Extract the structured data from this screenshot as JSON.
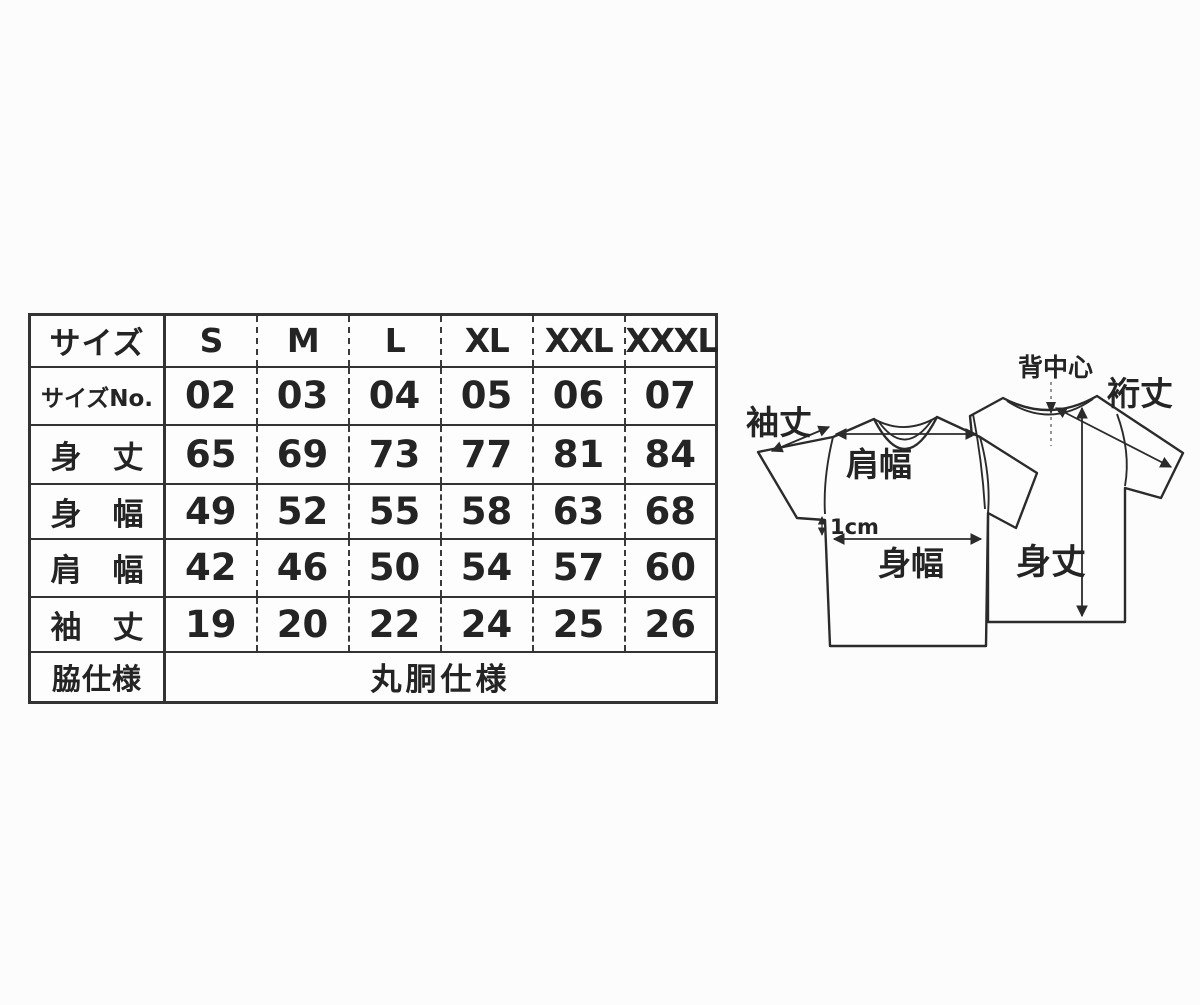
{
  "page": {
    "background": "#fcfcfc",
    "ink": "#2b2b2b",
    "border_color": "#333333"
  },
  "size_table": {
    "corner_label": "サイズ",
    "size_headers": [
      "S",
      "M",
      "L",
      "XL",
      "XXL",
      "XXXL"
    ],
    "rows": [
      {
        "label": "サイズNo.",
        "values": [
          "02",
          "03",
          "04",
          "05",
          "06",
          "07"
        ]
      },
      {
        "label": "身　丈",
        "values": [
          "65",
          "69",
          "73",
          "77",
          "81",
          "84"
        ]
      },
      {
        "label": "身　幅",
        "values": [
          "49",
          "52",
          "55",
          "58",
          "63",
          "68"
        ]
      },
      {
        "label": "肩　幅",
        "values": [
          "42",
          "46",
          "50",
          "54",
          "57",
          "60"
        ]
      },
      {
        "label": "袖　丈",
        "values": [
          "19",
          "20",
          "22",
          "24",
          "25",
          "26"
        ]
      }
    ],
    "footer": {
      "label": "脇仕様",
      "value": "丸胴仕様"
    }
  },
  "diagram": {
    "labels": {
      "sleeve_length": "袖丈",
      "shoulder_width": "肩幅",
      "offset_note": "1cm",
      "body_width": "身幅",
      "back_center": "背中心",
      "sleeve_from_center": "裄丈",
      "body_length": "身丈"
    }
  }
}
